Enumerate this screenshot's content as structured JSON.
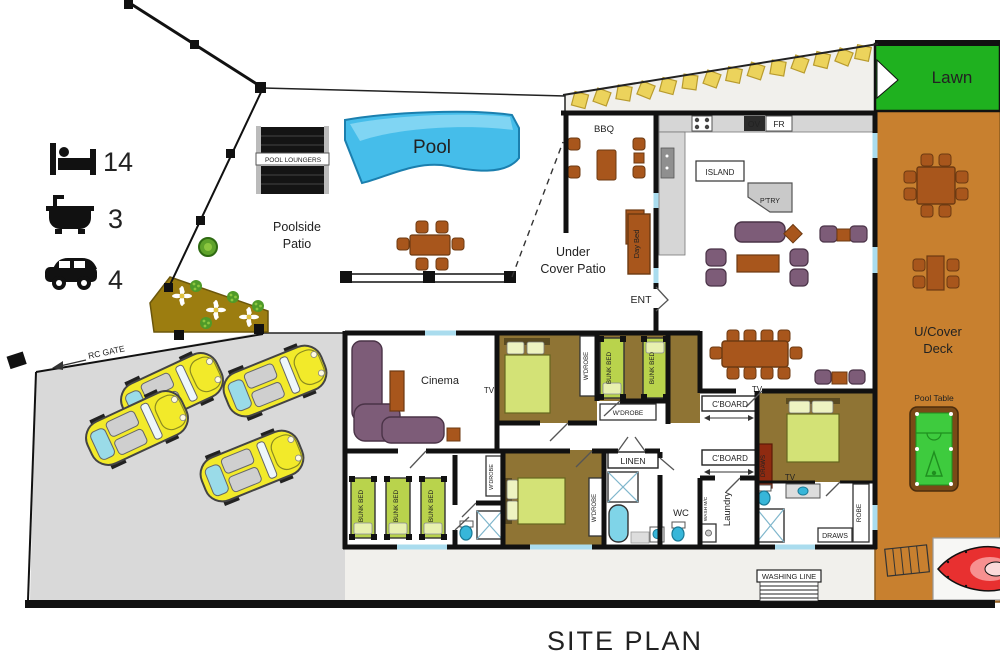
{
  "title": "SITE PLAN",
  "legend": {
    "beds": "14",
    "baths": "3",
    "cars": "4"
  },
  "areas": {
    "lawn": "Lawn",
    "deck1": "U/Cover",
    "deck2": "Deck",
    "pool_table": "Pool Table",
    "pool": "Pool",
    "pool_loungers": "POOL LOUNGERS",
    "poolside1": "Poolside",
    "poolside2": "Patio",
    "under1": "Under",
    "under2": "Cover Patio",
    "bbq": "BBQ",
    "ent": "ENT",
    "rc_gate": "RC GATE",
    "washing_line": "WASHING LINE"
  },
  "kitchen": {
    "island": "ISLAND",
    "oven": "OV",
    "fridge": "FR",
    "pantry": "P'TRY",
    "day_bed": "Day Bed"
  },
  "rooms": {
    "cinema": "Cinema",
    "tv": "TV",
    "wardrobe": "W'DROBE",
    "bunk_bed": "BUNK BED",
    "cupboard": "C'BOARD",
    "linen": "LINEN",
    "wc": "WC",
    "wash_mc": "WASH M/C",
    "laundry": "Laundry",
    "draws": "DRAWS",
    "robe": "ROBE"
  },
  "colors": {
    "pool": "#45bdea",
    "lawn": "#1fb11f",
    "deck": "#c8802f",
    "bedroom_floor": "#8f7434",
    "bed_green": "#d3e276",
    "bunk_green": "#b9d34c",
    "sofa_purple": "#7d5c78",
    "wood": "#a8561c",
    "driveway": "#d9d9d9",
    "garden": "#9c7d10",
    "stepping_stone": "#ecd35c",
    "pool_table_green": "#3ecb3e",
    "kayak_red": "#e83030",
    "window": "#aadcee",
    "wall": "#111111",
    "draws_red": "#8f2a10",
    "car_yellow": "#f2ea2a"
  }
}
